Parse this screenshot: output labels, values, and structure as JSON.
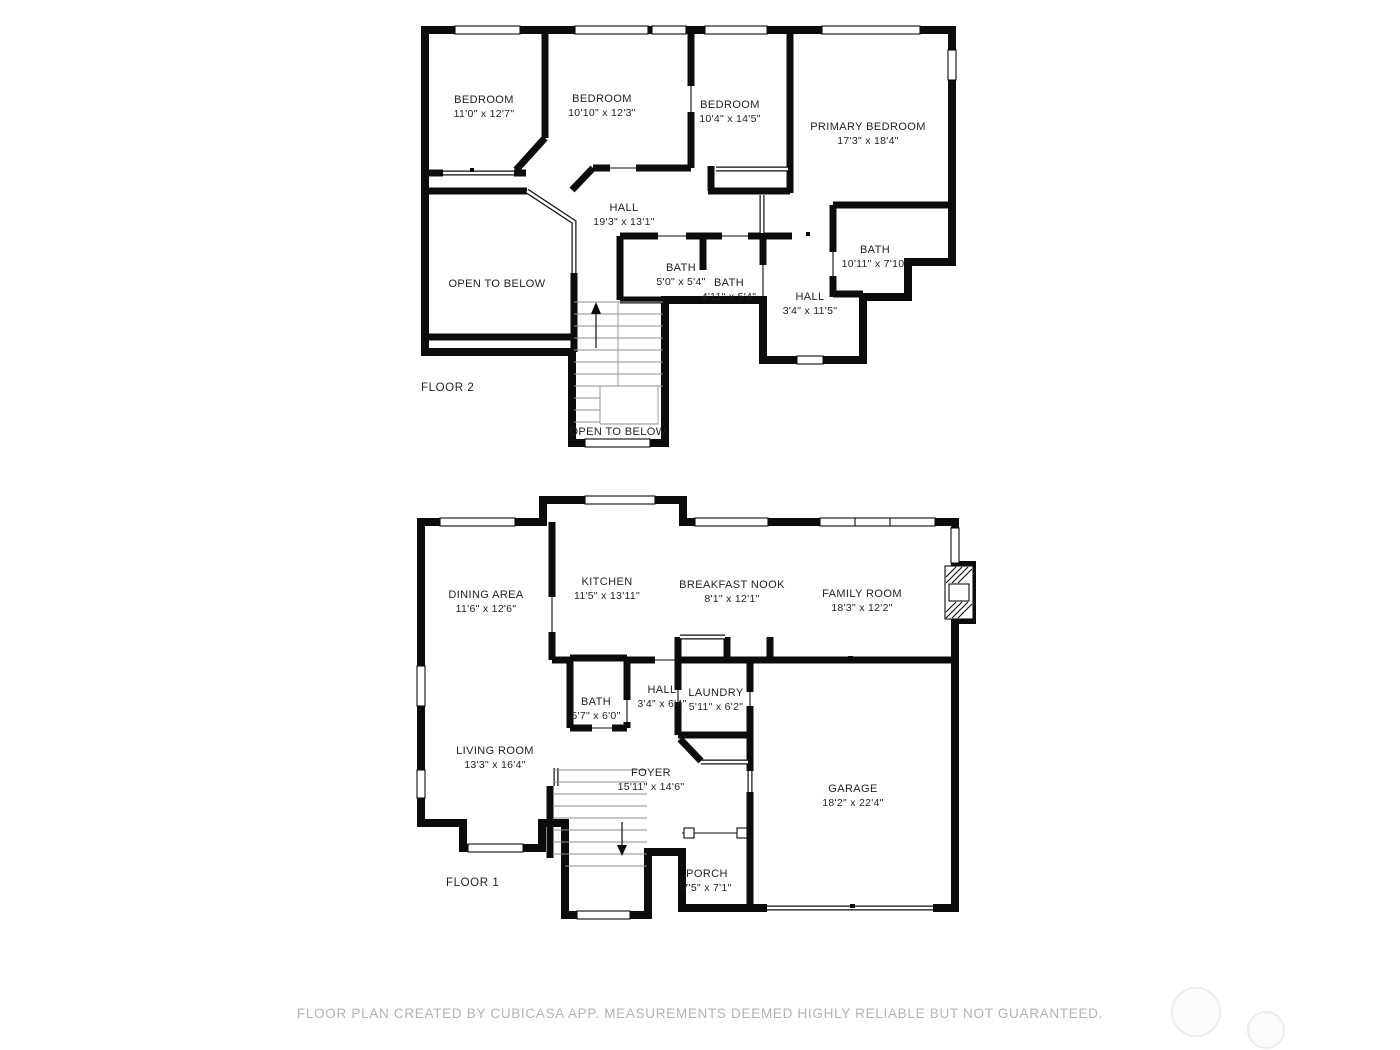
{
  "colors": {
    "wall": "#0c0c0c",
    "label_text": "#1f1f1f",
    "footer_text": "#b3b3b3",
    "stair_tread": "#8f8f8f",
    "watermark": "#ededed",
    "background": "#ffffff"
  },
  "footer": {
    "text": "FLOOR PLAN CREATED BY CUBICASA APP. MEASUREMENTS DEEMED HIGHLY RELIABLE BUT NOT GUARANTEED."
  },
  "floor2": {
    "label": "FLOOR 2",
    "rooms": [
      {
        "name": "BEDROOM",
        "dims": "11'0\" x 12'7\""
      },
      {
        "name": "BEDROOM",
        "dims": "10'10\" x 12'3\""
      },
      {
        "name": "BEDROOM",
        "dims": "10'4\" x 14'5\""
      },
      {
        "name": "PRIMARY BEDROOM",
        "dims": "17'3\" x 18'4\""
      },
      {
        "name": "HALL",
        "dims": "19'3\" x 13'1\""
      },
      {
        "name": "OPEN TO BELOW",
        "dims": ""
      },
      {
        "name": "BATH",
        "dims": "5'0\" x 5'4\""
      },
      {
        "name": "BATH",
        "dims": "4'11\" x 5'4\""
      },
      {
        "name": "BATH",
        "dims": "10'11\" x 7'10\""
      },
      {
        "name": "HALL",
        "dims": "3'4\" x 11'5\""
      },
      {
        "name": "OPEN TO BELOW",
        "dims": ""
      }
    ]
  },
  "floor1": {
    "label": "FLOOR 1",
    "rooms": [
      {
        "name": "DINING AREA",
        "dims": "11'6\" x 12'6\""
      },
      {
        "name": "KITCHEN",
        "dims": "11'5\" x 13'11\""
      },
      {
        "name": "BREAKFAST NOOK",
        "dims": "8'1\" x 12'1\""
      },
      {
        "name": "FAMILY ROOM",
        "dims": "18'3\" x 12'2\""
      },
      {
        "name": "BATH",
        "dims": "5'7\" x 6'0\""
      },
      {
        "name": "HALL",
        "dims": "3'4\" x 6'4\""
      },
      {
        "name": "LAUNDRY",
        "dims": "5'11\" x 6'2\""
      },
      {
        "name": "LIVING ROOM",
        "dims": "13'3\" x 16'4\""
      },
      {
        "name": "FOYER",
        "dims": "15'11\" x 14'6\""
      },
      {
        "name": "GARAGE",
        "dims": "18'2\" x 22'4\""
      },
      {
        "name": "PORCH",
        "dims": "7'5\" x 7'1\""
      }
    ]
  }
}
